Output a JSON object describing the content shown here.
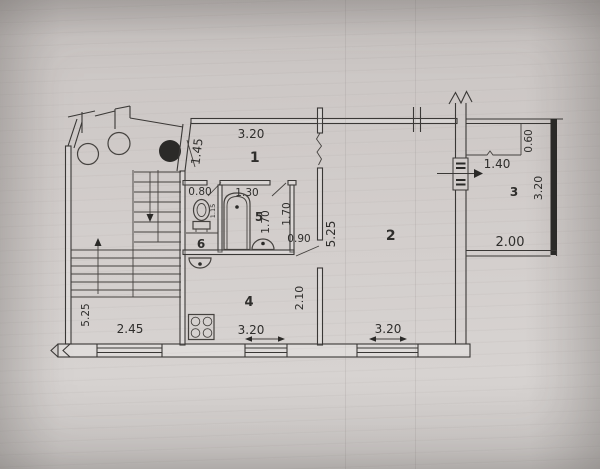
{
  "document": {
    "kind": "scanned apartment floor plan",
    "paper_color": "#cdc8c6",
    "ink_color": "#3a3836"
  },
  "rooms": {
    "hall": {
      "number": "1",
      "width": "3.20",
      "depth": "1.45"
    },
    "living": {
      "number": "2",
      "width": "3.20",
      "depth": "5.25"
    },
    "balcony": {
      "number": "3",
      "width_top": "1.40",
      "width_bottom": "2.00",
      "depth": "3.20",
      "closet_depth": "0.60"
    },
    "kitchen": {
      "number": "4",
      "width": "3.20",
      "depth": "2.10"
    },
    "bathroom": {
      "number": "5",
      "width": "1.30",
      "depth": "1.70"
    },
    "wc": {
      "number": "6",
      "width": "0.80",
      "depth": "1.15"
    },
    "stairwell": {
      "width": "2.45",
      "depth": "5.25"
    },
    "corridor": {
      "depth": "1.70",
      "door_width": "0.90"
    }
  },
  "icons": {
    "fixtures": [
      "bathtub-icon",
      "toilet-icon",
      "wash-basin-icon",
      "kitchen-sink-icon",
      "stove-icon",
      "garbage-chute-icon",
      "ventilation-shaft-icon"
    ],
    "symbols": [
      "balcony-exit-arrow-icon",
      "stair-direction-arrow-icon",
      "dimension-arrow-icon",
      "wall-break-symbol",
      "window-symbol"
    ]
  }
}
